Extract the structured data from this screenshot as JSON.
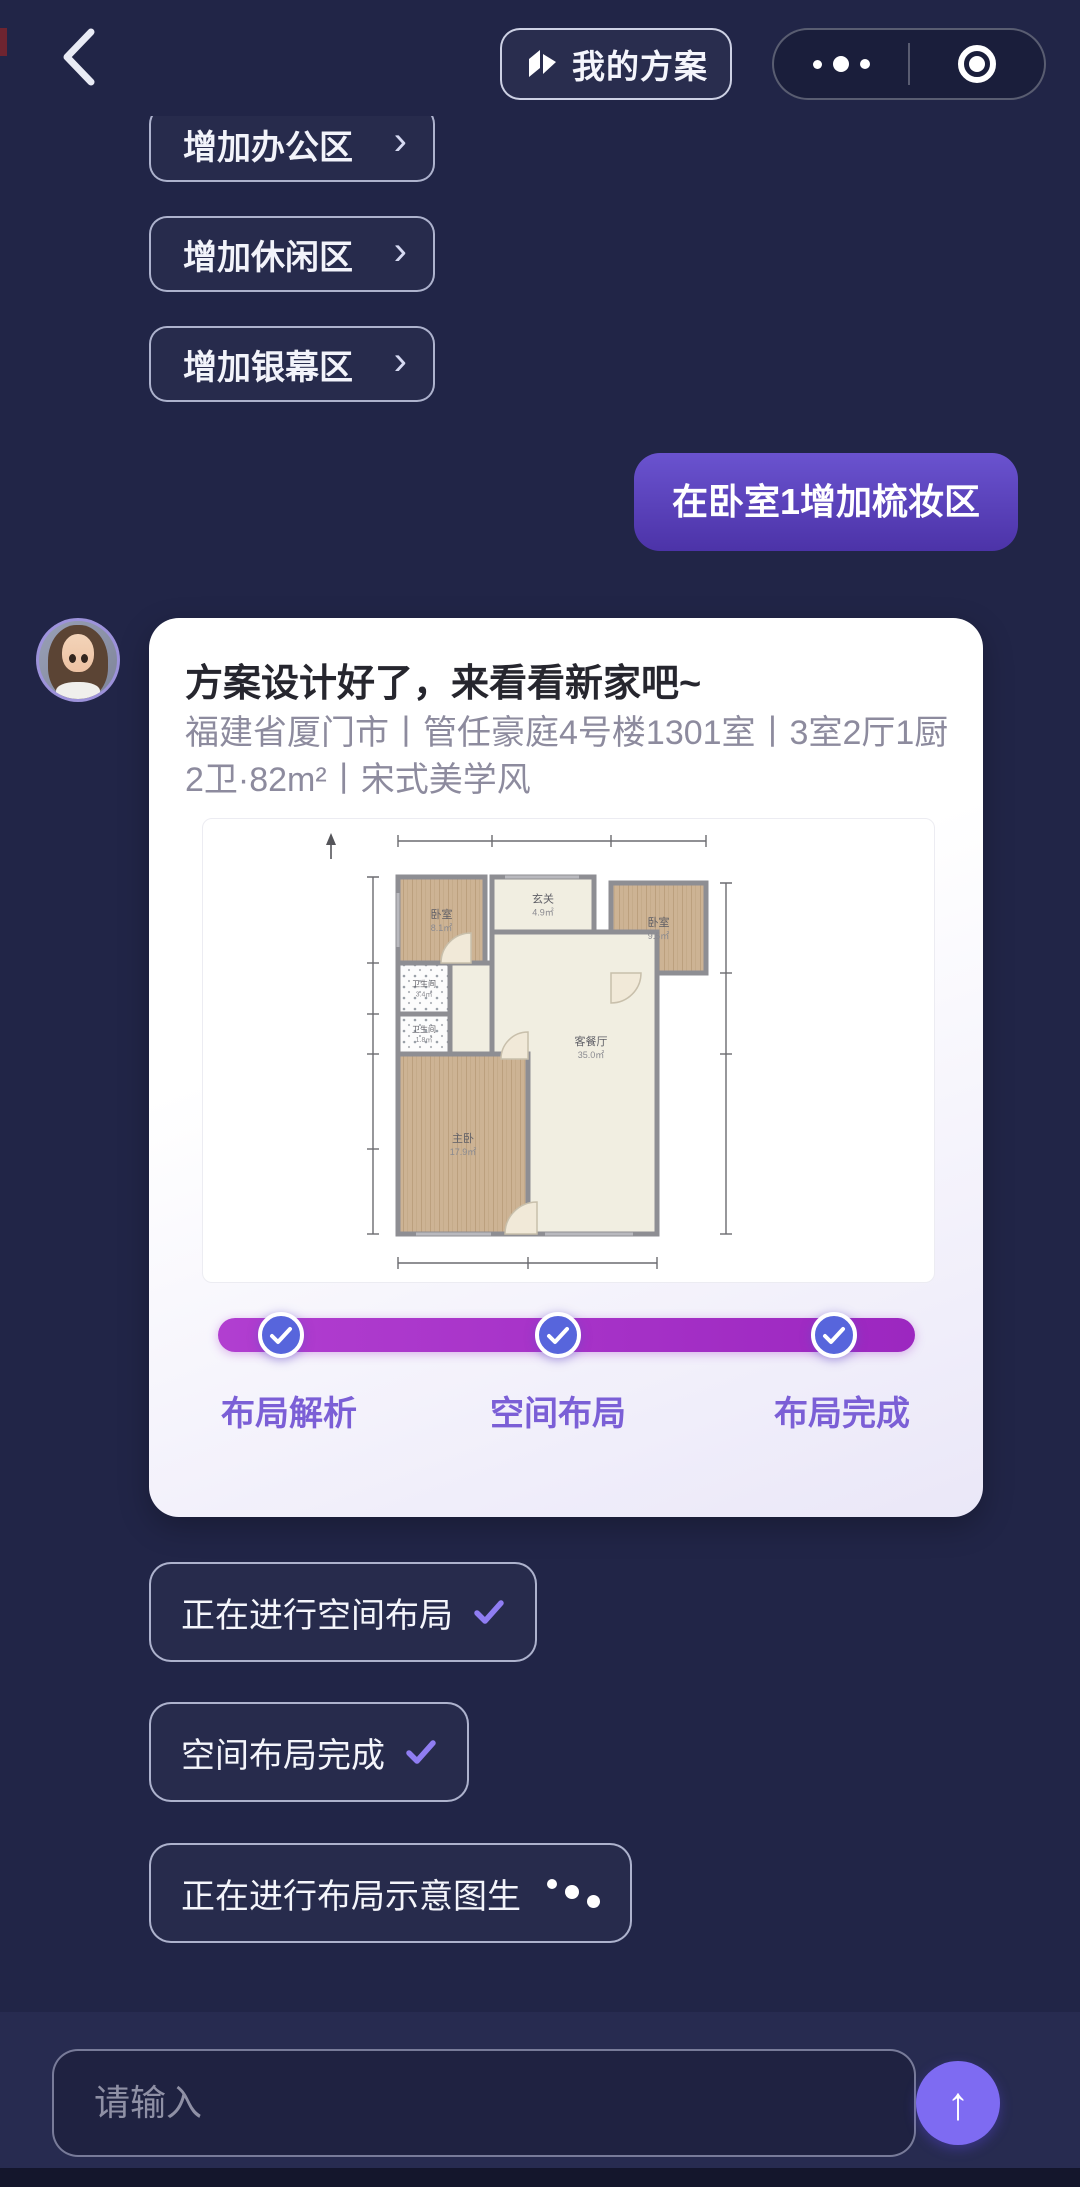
{
  "nav": {
    "my_plan_label": "我的方案",
    "back_icon": "chevron-left",
    "more_icon": "three-dots",
    "circle_icon": "record-circle"
  },
  "suggestions": [
    {
      "key": "add-office-area",
      "label": "增加办公区",
      "arrow": "›"
    },
    {
      "key": "add-leisure-area",
      "label": "增加休闲区",
      "arrow": "›"
    },
    {
      "key": "add-screen-area",
      "label": "增加银幕区",
      "arrow": "›"
    }
  ],
  "user_message": {
    "text": "在卧室1增加梳妆区"
  },
  "assistant_card": {
    "title": "方案设计好了，来看看新家吧~",
    "subtitle": "福建省厦门市丨管任豪庭4号楼1301室丨3室2厅1厨2卫·82m²丨宋式美学风",
    "progress_steps": [
      {
        "key": "layout-analysis",
        "label": "布局解析",
        "done": true
      },
      {
        "key": "space-layout",
        "label": "空间布局",
        "done": true
      },
      {
        "key": "layout-complete",
        "label": "布局完成",
        "done": true
      }
    ]
  },
  "floor_plan": {
    "rooms": [
      {
        "key": "bedroom-2",
        "label": "卧室",
        "area": "8.1㎡",
        "fill": "wood",
        "x": 195,
        "y": 58,
        "w": 87,
        "h": 86
      },
      {
        "key": "hallway",
        "label": "玄关",
        "area": "4.9㎡",
        "fill": "cream",
        "x": 289,
        "y": 58,
        "w": 102,
        "h": 55
      },
      {
        "key": "bedroom-3",
        "label": "卧室",
        "area": "9.5㎡",
        "fill": "wood",
        "x": 408,
        "y": 64,
        "w": 95,
        "h": 90
      },
      {
        "key": "corridor",
        "label": "",
        "area": "",
        "fill": "cream",
        "x": 247,
        "y": 144,
        "w": 42,
        "h": 91
      },
      {
        "key": "living-dining",
        "label": "客餐厅",
        "area": "35.0㎡",
        "fill": "cream",
        "path": "M289,113 H454 V415 H325 V235 H289 Z",
        "lx": 388,
        "ly": 228
      },
      {
        "key": "bathroom-1",
        "label": "卫生间",
        "area": "3.4㎡",
        "fill": "tile",
        "x": 195,
        "y": 144,
        "w": 52,
        "h": 51
      },
      {
        "key": "bathroom-2",
        "label": "卫生间",
        "area": "1.8㎡",
        "fill": "tile",
        "x": 195,
        "y": 195,
        "w": 52,
        "h": 40
      },
      {
        "key": "master-bedroom",
        "label": "主卧",
        "area": "17.9㎡",
        "fill": "wood",
        "x": 195,
        "y": 235,
        "w": 130,
        "h": 180
      }
    ],
    "doors": [
      {
        "cx": 268,
        "cy": 144,
        "r": 30,
        "a0": 180,
        "a1": 270
      },
      {
        "cx": 408,
        "cy": 154,
        "r": 30,
        "a0": 90,
        "a1": 0
      },
      {
        "cx": 325,
        "cy": 240,
        "r": 27,
        "a0": 180,
        "a1": 270
      },
      {
        "cx": 334,
        "cy": 415,
        "r": 32,
        "a0": 180,
        "a1": 270
      }
    ]
  },
  "status_chips": [
    {
      "key": "spatial-layout-progress",
      "label": "正在进行空间布局",
      "icon": "check",
      "top": 1562
    },
    {
      "key": "spatial-layout-done",
      "label": "空间布局完成",
      "icon": "check",
      "top": 1702
    },
    {
      "key": "diagram-generating",
      "label": "正在进行布局示意图生",
      "icon": "loading",
      "top": 1843
    }
  ],
  "composer": {
    "placeholder": "请输入",
    "send_icon": "↑"
  },
  "colors": {
    "background": "#212547",
    "user_bubble_top": "#6a53cf",
    "user_bubble_bottom": "#4c33a8",
    "progress_bar": "#a32fc4",
    "progress_node": "#5765dc",
    "progress_label": "#7b5fd6",
    "chip_check": "#8f7df2",
    "send_button": "#7e6bf2"
  }
}
